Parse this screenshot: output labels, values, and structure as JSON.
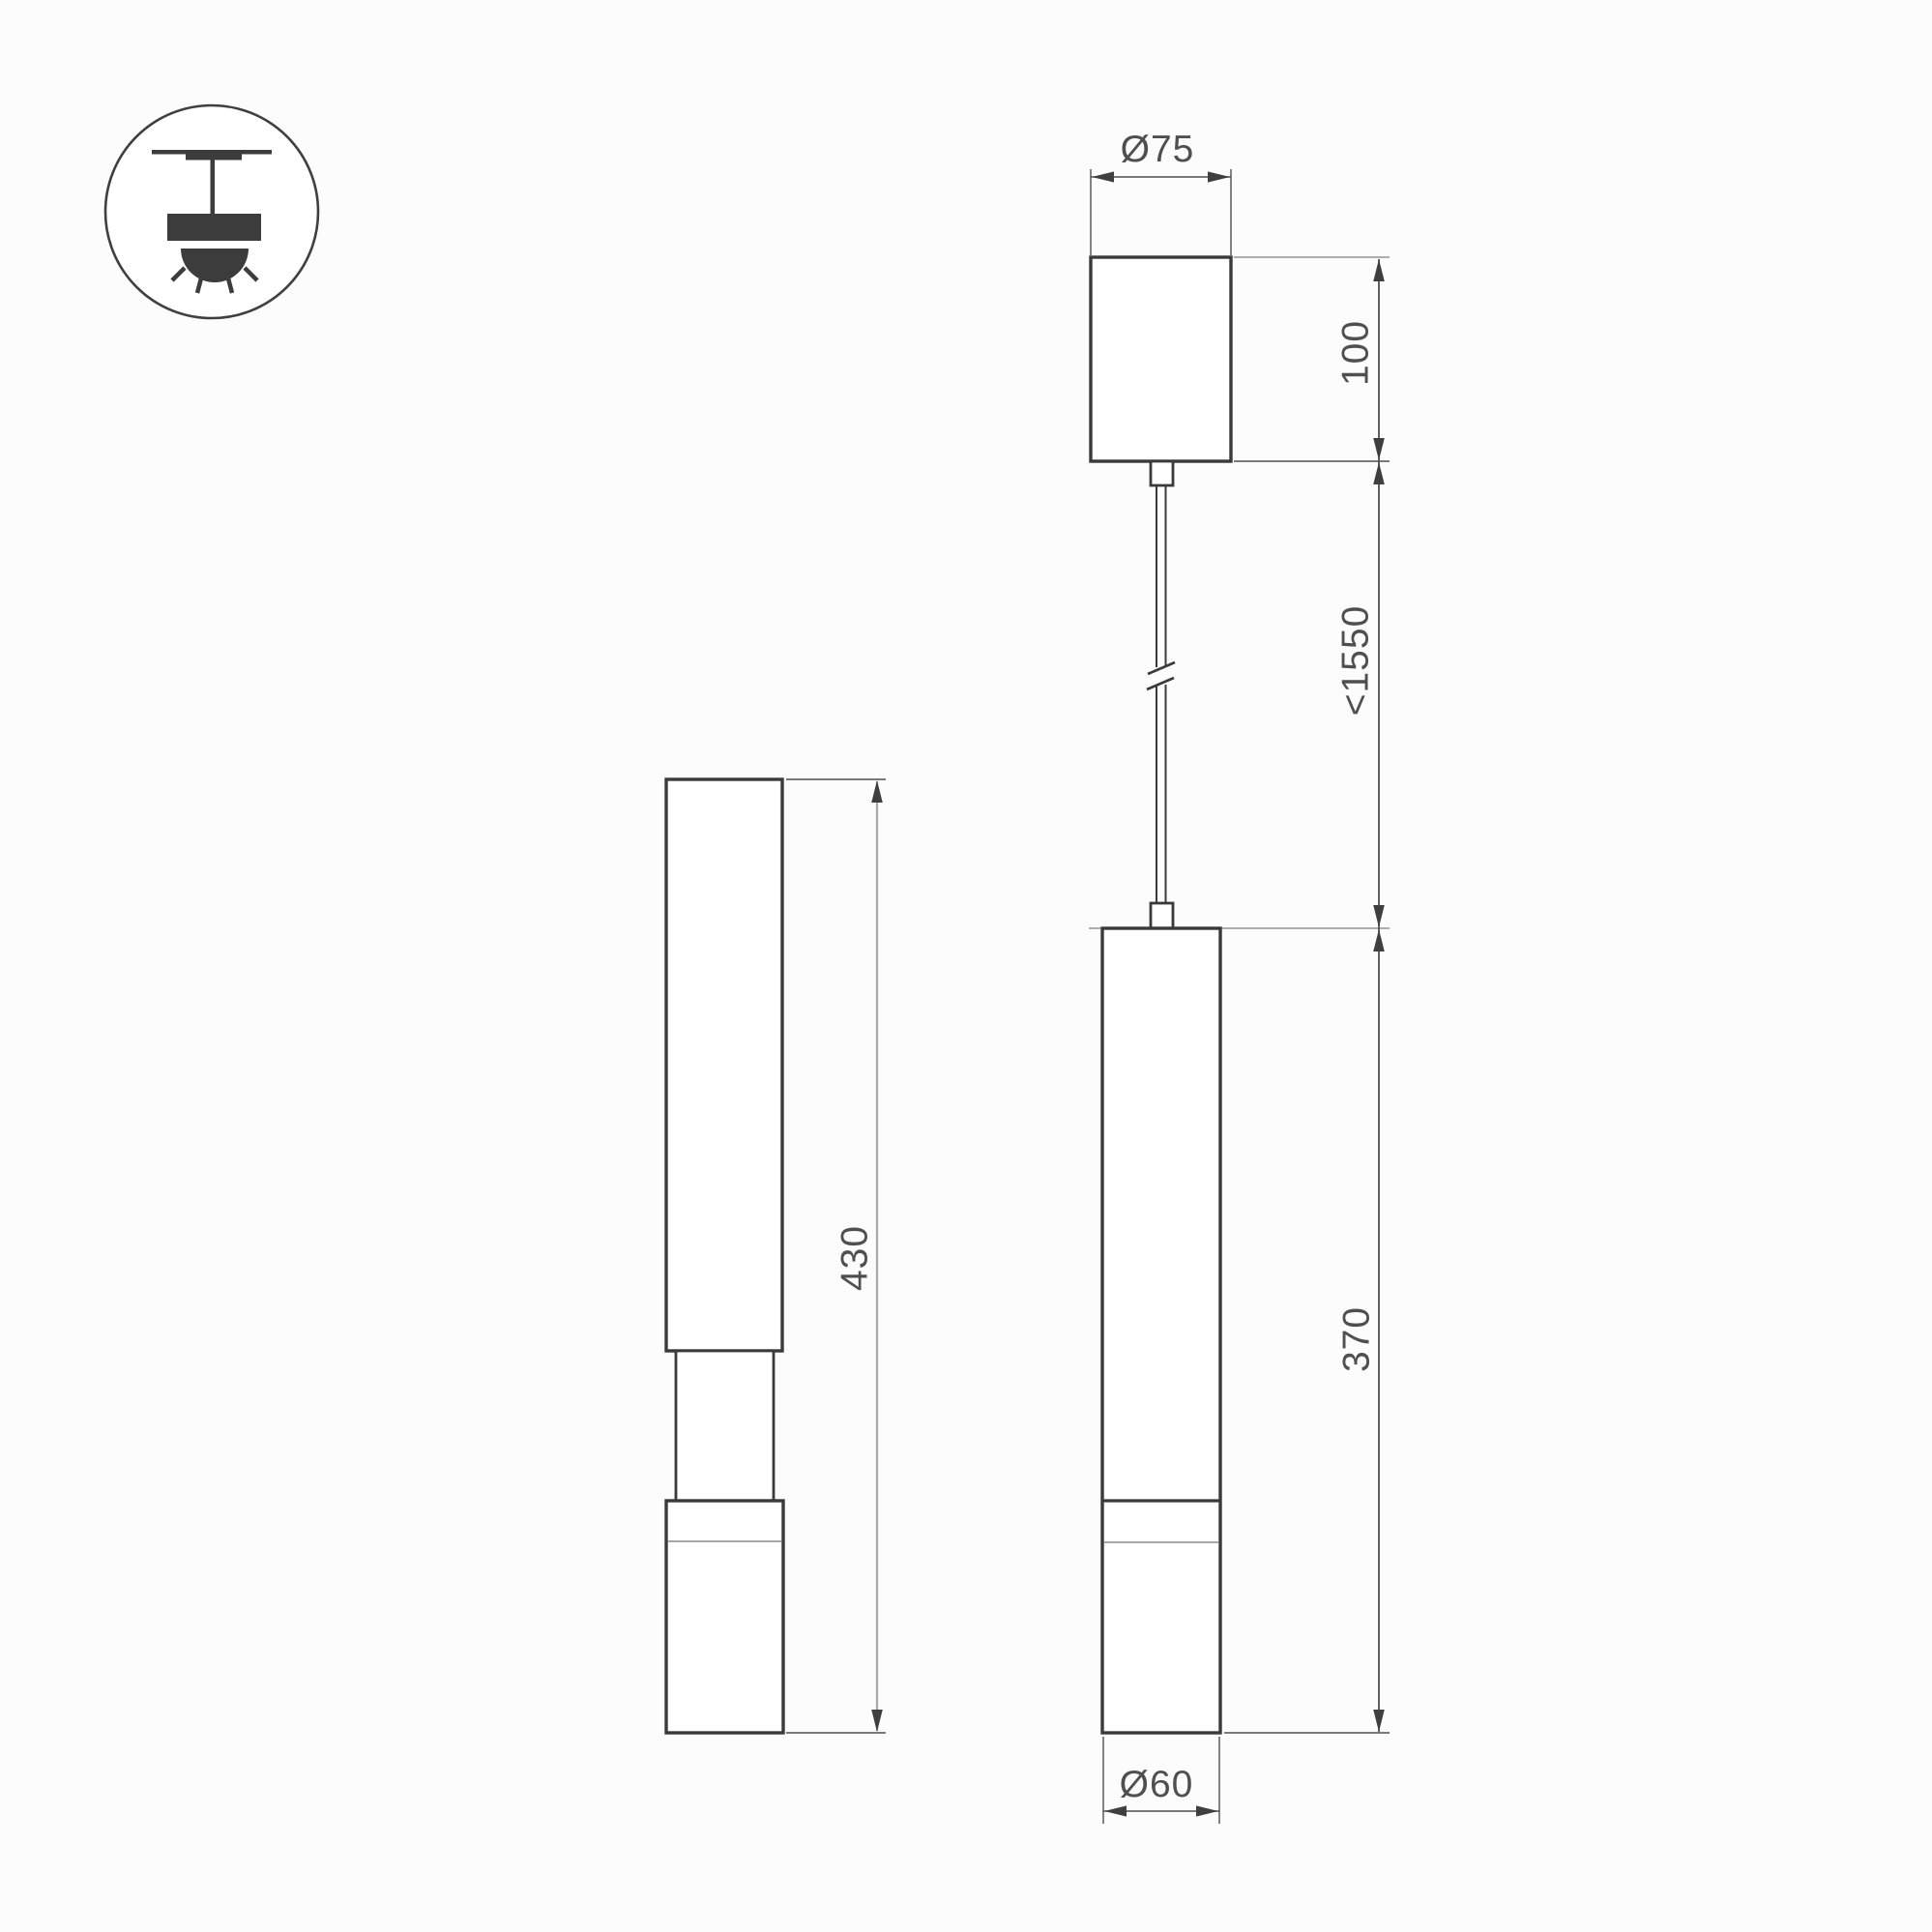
{
  "page": {
    "background": "#fcfcfc",
    "outline_color": "#3a3a3a",
    "dim_line_color": "#4f4f4f",
    "light_line_color": "#a6a6a6",
    "text_color": "#4f4f4f"
  },
  "labels": {
    "canopy_diameter": "Ø75",
    "canopy_height": "100",
    "max_suspension": "<1550",
    "body_height": "370",
    "body_diameter": "Ø60",
    "side_height": "430"
  }
}
